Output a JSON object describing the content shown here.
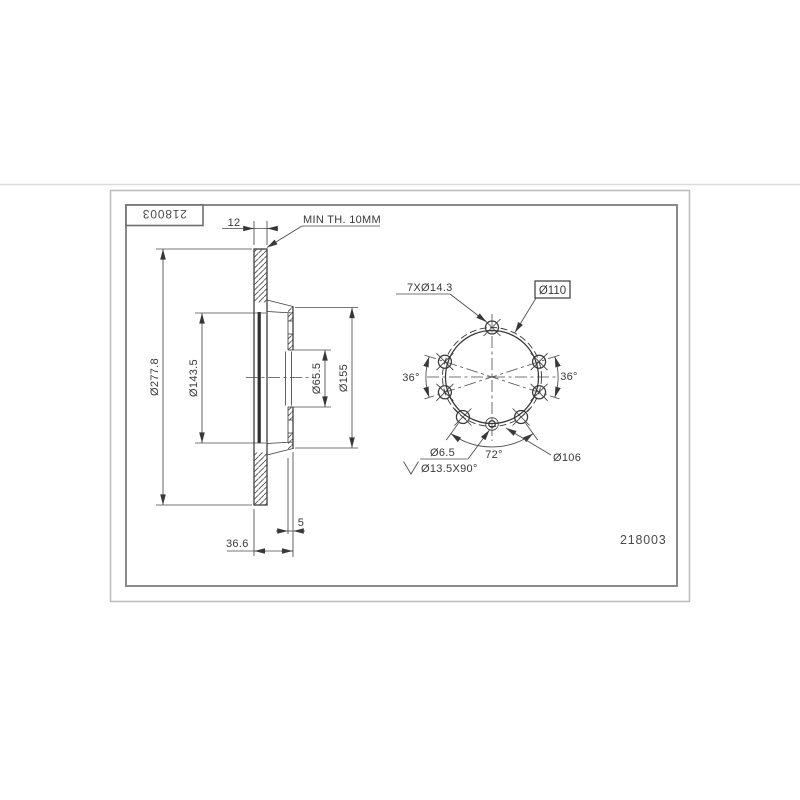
{
  "drawing": {
    "title_block": {
      "part_number": "218003"
    },
    "footer": {
      "part_number": "218003"
    },
    "section_view": {
      "dim_thickness": "12",
      "note_min_thickness": "MIN TH. 10MM",
      "dim_outer_diameter": "Ø277.8",
      "dim_hat_inner_diameter": "Ø143.5",
      "dim_bore_diameter": "Ø65.5",
      "dim_hat_outer_diameter": "Ø155",
      "dim_mount_wall_thickness": "5",
      "dim_total_width": "36.6"
    },
    "front_view": {
      "label_bolt_holes": "7XØ14.3",
      "label_bolt_circle": "Ø110",
      "label_angle_left": "36°",
      "label_angle_right": "36°",
      "label_angle_bottom": "72°",
      "label_pin_hole": "Ø6.5",
      "label_countersink": "Ø13.5X90°",
      "label_pin_circle": "Ø106"
    },
    "colors": {
      "line": "#383838",
      "border_inner": "#7d7d7d",
      "border_outer": "#bdbdbd",
      "background": "#ffffff"
    }
  }
}
